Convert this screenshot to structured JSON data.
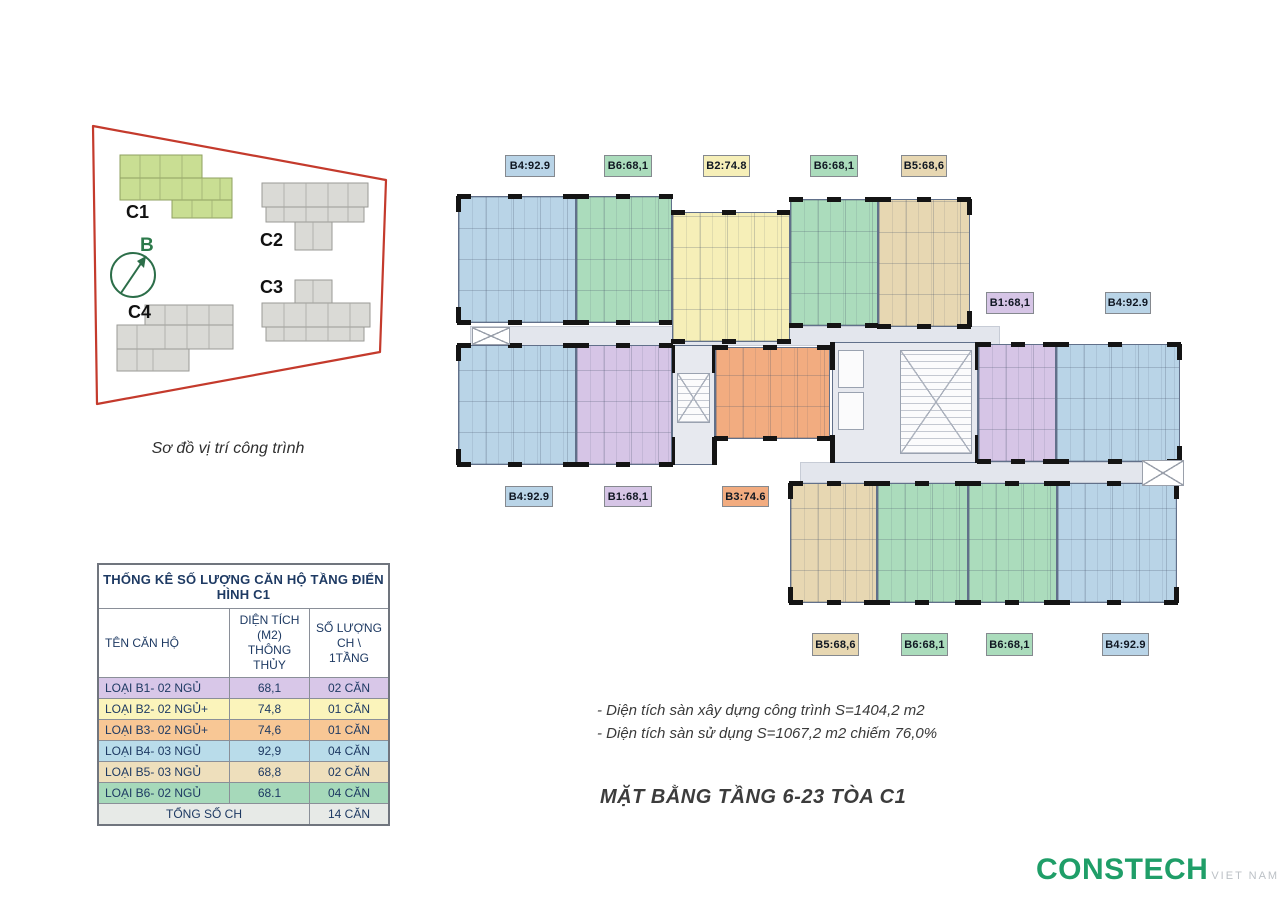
{
  "site": {
    "caption": "Sơ đồ vị trí công trình",
    "boundary_color": "#c43a2c",
    "labels": {
      "c1": "C1",
      "c2": "C2",
      "c3": "C3",
      "c4": "C4",
      "compass": "B"
    },
    "highlight_building": "C1"
  },
  "table": {
    "title": "THỐNG KÊ SỐ LƯỢNG CĂN HỘ TẦNG ĐIỂN HÌNH C1",
    "columns": [
      {
        "line1": "TÊN CĂN HỘ",
        "line2": ""
      },
      {
        "line1": "DIỆN TÍCH (M2)",
        "line2": "THÔNG THỦY"
      },
      {
        "line1": "SỐ LƯỢNG",
        "line2": "CH \\ 1TẦNG"
      }
    ],
    "rows": [
      {
        "label": "LOẠI B1- 02 NGỦ",
        "area": "68,1",
        "count": "02 CĂN",
        "color": "#d8c7e8"
      },
      {
        "label": "LOẠI B2- 02 NGỦ+",
        "area": "74,8",
        "count": "01 CĂN",
        "color": "#fbf4bb"
      },
      {
        "label": "LOẠI B3- 02 NGỦ+",
        "area": "74,6",
        "count": "01 CĂN",
        "color": "#f8c795"
      },
      {
        "label": "LOẠI B4- 03 NGỦ",
        "area": "92,9",
        "count": "04 CĂN",
        "color": "#b9dcea"
      },
      {
        "label": "LOẠI B5- 03 NGỦ",
        "area": "68,8",
        "count": "02 CĂN",
        "color": "#eedfbc"
      },
      {
        "label": "LOẠI B6- 02 NGỦ",
        "area": "68.1",
        "count": "04 CĂN",
        "color": "#a6d9ba"
      },
      {
        "label": "TỔNG SỐ CH",
        "area": "",
        "count": "14 CĂN",
        "color": "#e7eae7",
        "total": true
      }
    ]
  },
  "floorplan": {
    "colors": {
      "blue": "#b9d4e7",
      "green": "#abdcbc",
      "yellow": "#f6efb8",
      "tan": "#e7d7b2",
      "purple": "#d6c5e6",
      "orange": "#f2ac80"
    },
    "corridors": [
      {
        "x": 470,
        "y": 326,
        "w": 530,
        "h": 20
      },
      {
        "x": 800,
        "y": 462,
        "w": 345,
        "h": 21
      }
    ],
    "units": [
      {
        "type": "B4",
        "color": "blue",
        "x": 458,
        "y": 196,
        "w": 118,
        "h": 127,
        "vleft": true
      },
      {
        "type": "B6",
        "color": "green",
        "x": 576,
        "y": 196,
        "w": 96,
        "h": 127
      },
      {
        "type": "B2",
        "color": "yellow",
        "x": 672,
        "y": 212,
        "w": 118,
        "h": 130
      },
      {
        "type": "B6",
        "color": "green",
        "x": 790,
        "y": 199,
        "w": 88,
        "h": 127
      },
      {
        "type": "B5",
        "color": "tan",
        "x": 878,
        "y": 199,
        "w": 92,
        "h": 128,
        "vright": true
      },
      {
        "type": "B4",
        "color": "blue",
        "x": 458,
        "y": 345,
        "w": 118,
        "h": 120,
        "vleft": true
      },
      {
        "type": "B1",
        "color": "purple",
        "x": 576,
        "y": 345,
        "w": 96,
        "h": 120
      },
      {
        "type": "B3",
        "color": "orange",
        "x": 715,
        "y": 347,
        "w": 115,
        "h": 92
      },
      {
        "type": "B1",
        "color": "purple",
        "x": 978,
        "y": 344,
        "w": 78,
        "h": 118
      },
      {
        "type": "B4",
        "color": "blue",
        "x": 1056,
        "y": 344,
        "w": 124,
        "h": 118,
        "vright": true
      },
      {
        "type": "B5",
        "color": "tan",
        "x": 790,
        "y": 483,
        "w": 87,
        "h": 120,
        "vleft": true
      },
      {
        "type": "B6",
        "color": "green",
        "x": 877,
        "y": 483,
        "w": 91,
        "h": 120
      },
      {
        "type": "B6",
        "color": "green",
        "x": 968,
        "y": 483,
        "w": 89,
        "h": 120
      },
      {
        "type": "B4",
        "color": "blue",
        "x": 1057,
        "y": 483,
        "w": 120,
        "h": 120,
        "vright": true
      }
    ],
    "cores": [
      {
        "kind": "stair",
        "x": 672,
        "y": 345,
        "w": 43,
        "h": 120
      },
      {
        "kind": "services",
        "x": 832,
        "y": 342,
        "w": 146,
        "h": 121
      }
    ],
    "voids": [
      {
        "x": 472,
        "y": 327,
        "w": 38,
        "h": 18
      },
      {
        "x": 1142,
        "y": 460,
        "w": 42,
        "h": 26
      }
    ],
    "badges": [
      {
        "text": "B4:92.9",
        "color": "blue",
        "x": 505,
        "y": 155,
        "w": 50,
        "h": 22
      },
      {
        "text": "B6:68,1",
        "color": "green",
        "x": 604,
        "y": 155,
        "w": 48,
        "h": 22
      },
      {
        "text": "B2:74.8",
        "color": "yellow",
        "x": 703,
        "y": 155,
        "w": 47,
        "h": 22
      },
      {
        "text": "B6:68,1",
        "color": "green",
        "x": 810,
        "y": 155,
        "w": 48,
        "h": 22
      },
      {
        "text": "B5:68,6",
        "color": "tan",
        "x": 901,
        "y": 155,
        "w": 46,
        "h": 22
      },
      {
        "text": "B1:68,1",
        "color": "purple",
        "x": 986,
        "y": 292,
        "w": 48,
        "h": 22
      },
      {
        "text": "B4:92.9",
        "color": "blue",
        "x": 1105,
        "y": 292,
        "w": 46,
        "h": 22
      },
      {
        "text": "B4:92.9",
        "color": "blue",
        "x": 505,
        "y": 486,
        "w": 48,
        "h": 21
      },
      {
        "text": "B1:68,1",
        "color": "purple",
        "x": 604,
        "y": 486,
        "w": 48,
        "h": 21
      },
      {
        "text": "B3:74.6",
        "color": "orange",
        "x": 722,
        "y": 486,
        "w": 47,
        "h": 21
      },
      {
        "text": "B5:68,6",
        "color": "tan",
        "x": 812,
        "y": 633,
        "w": 47,
        "h": 23
      },
      {
        "text": "B6:68,1",
        "color": "green",
        "x": 901,
        "y": 633,
        "w": 47,
        "h": 23
      },
      {
        "text": "B6:68,1",
        "color": "green",
        "x": 986,
        "y": 633,
        "w": 47,
        "h": 23
      },
      {
        "text": "B4:92.9",
        "color": "blue",
        "x": 1102,
        "y": 633,
        "w": 47,
        "h": 23
      }
    ]
  },
  "notes": {
    "line1": "- Diện tích sàn xây dựng công trình S=1404,2 m2",
    "line2": "- Diện tích sàn sử dụng S=1067,2 m2 chiếm 76,0%"
  },
  "caption": {
    "title": "MẶT BẰNG TẦNG 6-23 TÒA C1"
  },
  "logo": {
    "name": "CONSTECH",
    "sub": "VIET NAM",
    "color": "#1f9e68"
  }
}
